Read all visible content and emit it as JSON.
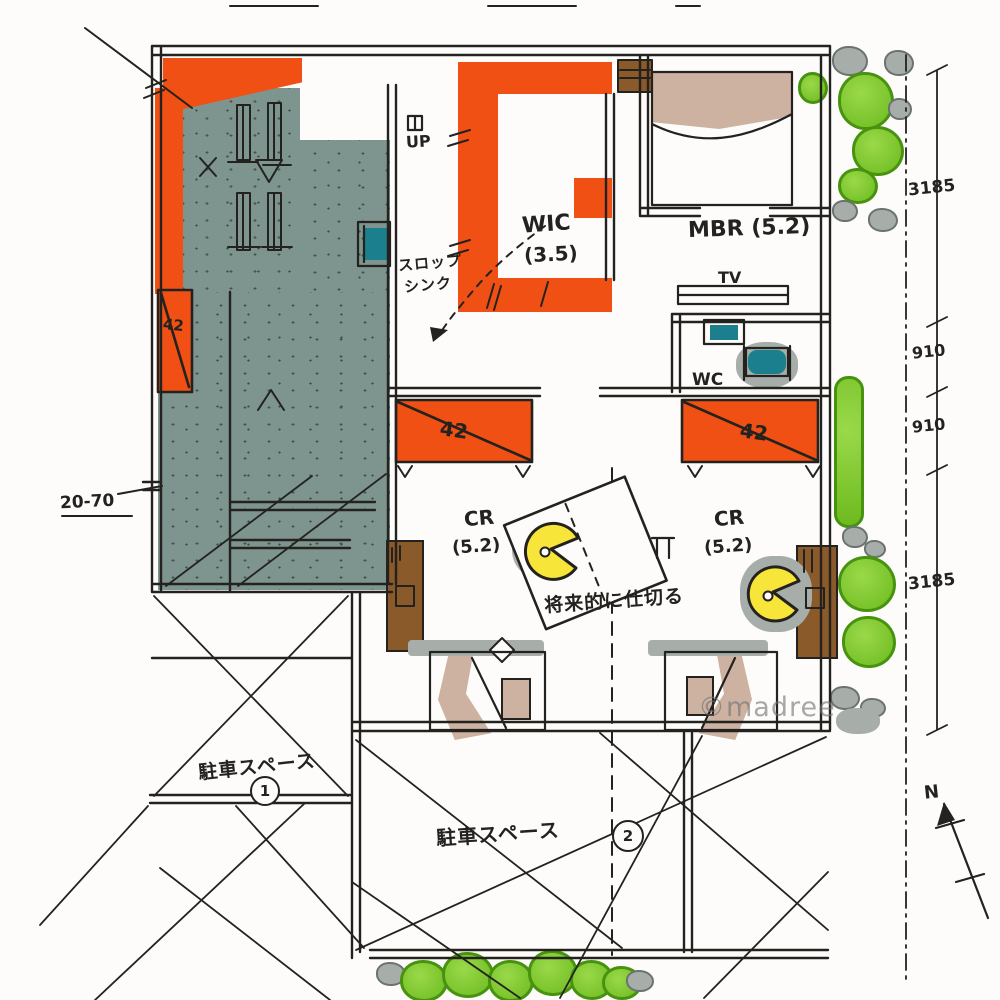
{
  "plan": {
    "rooms": {
      "wic": {
        "name": "WIC",
        "size": "(3.5)"
      },
      "mbr": {
        "name": "MBR (5.2)"
      },
      "cr_left": {
        "name": "CR",
        "size": "(5.2)"
      },
      "cr_right": {
        "name": "CR",
        "size": "(5.2)"
      },
      "tv": "TV",
      "wc": "WC"
    },
    "stairs": {
      "up": "UP"
    },
    "fixtures": {
      "slop_sink_line1": "スロップ",
      "slop_sink_line2": "シンク"
    },
    "closets": {
      "label": "42"
    },
    "notes": {
      "partition": "将来的に仕切る",
      "left_dim": "20-70"
    },
    "parking": {
      "p1_label": "駐車スペース",
      "p1_num": "1",
      "p2_label": "駐車スペース",
      "p2_num": "2"
    },
    "dimensions": {
      "right": [
        "3185",
        "910",
        "910",
        "3185"
      ]
    },
    "compass": {
      "north": "N"
    },
    "watermark": "©madree",
    "colors": {
      "orange": "#f05014",
      "slate": "#7e948e",
      "green": "#7cc832",
      "brown": "#8a5a2a",
      "tan": "#cdb2a2",
      "yellow": "#f7e53a",
      "teal": "#1b7f8e",
      "ink": "#24221f"
    }
  }
}
